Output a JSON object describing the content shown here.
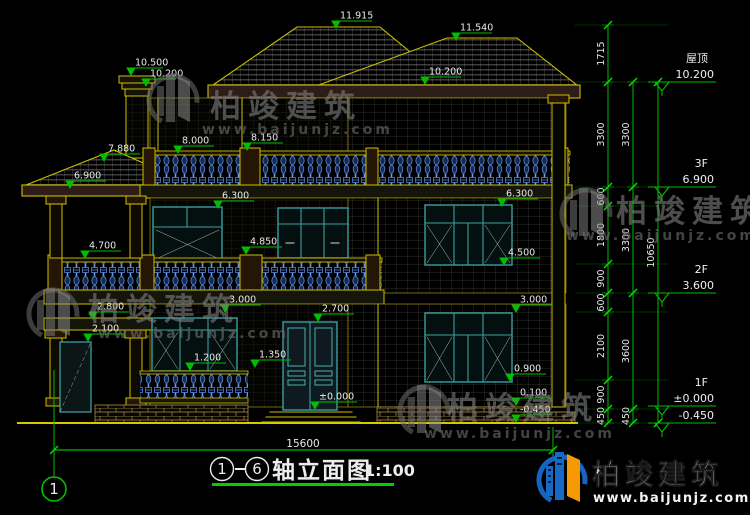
{
  "drawing": {
    "title": {
      "axis_start": "1",
      "axis_end": "6",
      "name": "轴立面图",
      "scale": "1:100",
      "dash": "—"
    },
    "axis_bubble": "1",
    "bottom_dimension": "15600",
    "elevation_markers": [
      {
        "v": "11.915",
        "x": 336,
        "y": 29
      },
      {
        "v": "11.540",
        "x": 456,
        "y": 41
      },
      {
        "v": "10.500",
        "x": 131,
        "y": 76,
        "len": 32
      },
      {
        "v": "10.200",
        "x": 146,
        "y": 87,
        "len": 30
      },
      {
        "v": "10.200",
        "x": 425,
        "y": 85
      },
      {
        "v": "8.000",
        "x": 178,
        "y": 154
      },
      {
        "v": "8.150",
        "x": 247,
        "y": 151
      },
      {
        "v": "7.880",
        "x": 104,
        "y": 162
      },
      {
        "v": "6.900",
        "x": 70,
        "y": 189
      },
      {
        "v": "6.300",
        "x": 218,
        "y": 209
      },
      {
        "v": "6.300",
        "x": 502,
        "y": 207
      },
      {
        "v": "4.850",
        "x": 246,
        "y": 255
      },
      {
        "v": "4.700",
        "x": 85,
        "y": 259
      },
      {
        "v": "4.500",
        "x": 504,
        "y": 266
      },
      {
        "v": "3.000",
        "x": 225,
        "y": 313
      },
      {
        "v": "2.800",
        "x": 93,
        "y": 320
      },
      {
        "v": "2.100",
        "x": 88,
        "y": 342
      },
      {
        "v": "2.700",
        "x": 318,
        "y": 322
      },
      {
        "v": "1.350",
        "x": 255,
        "y": 368
      },
      {
        "v": "1.200",
        "x": 190,
        "y": 371
      },
      {
        "v": "3.000",
        "x": 516,
        "y": 313
      },
      {
        "v": "0.900",
        "x": 510,
        "y": 382
      },
      {
        "v": "±0.000",
        "x": 315,
        "y": 410,
        "len": 42
      },
      {
        "v": "0.100",
        "x": 516,
        "y": 406
      },
      {
        "v": "-0.450",
        "x": 516,
        "y": 423
      }
    ],
    "right_dimension_chains": [
      {
        "x": 608,
        "nodes": [
          25,
          82,
          187,
          206,
          264,
          293,
          312,
          380,
          409,
          423
        ],
        "values": [
          "1715",
          "3300",
          "600",
          "1800",
          "900",
          "600",
          "2100",
          "900",
          "450"
        ]
      },
      {
        "x": 633,
        "nodes": [
          82,
          187,
          293,
          409,
          423
        ],
        "values": [
          "3300",
          "3300",
          "3600",
          "450"
        ]
      },
      {
        "x": 658,
        "nodes": [
          82,
          423
        ],
        "values": [
          "10650"
        ]
      }
    ],
    "levels": [
      {
        "label": "屋顶",
        "value": "10.200",
        "y": 82
      },
      {
        "label": "3F",
        "value": "6.900",
        "y": 187
      },
      {
        "label": "2F",
        "value": "3.600",
        "y": 293
      },
      {
        "label": "1F",
        "value": "±0.000",
        "y": 406
      },
      {
        "label": "",
        "value": "-0.450",
        "y": 423
      }
    ]
  },
  "watermark": {
    "brand": "柏竣建筑",
    "url": "www.baijunjz.com"
  },
  "logo": {
    "brand": "柏竣建筑",
    "url": "www.baijunjz.com"
  },
  "colors": {
    "background": "#000000",
    "outline_yellow": "#cfbf00",
    "dimension_green": "#00bf00",
    "baluster_blue": "#4d80d8",
    "window_teal": "#3b9e9e",
    "eave_maroon": "#2e1d16",
    "text_white": "#e9e9e9",
    "watermark_gray": "#7d7d7d",
    "logo_blue": "#1565c0",
    "logo_orange": "#f59a00"
  }
}
